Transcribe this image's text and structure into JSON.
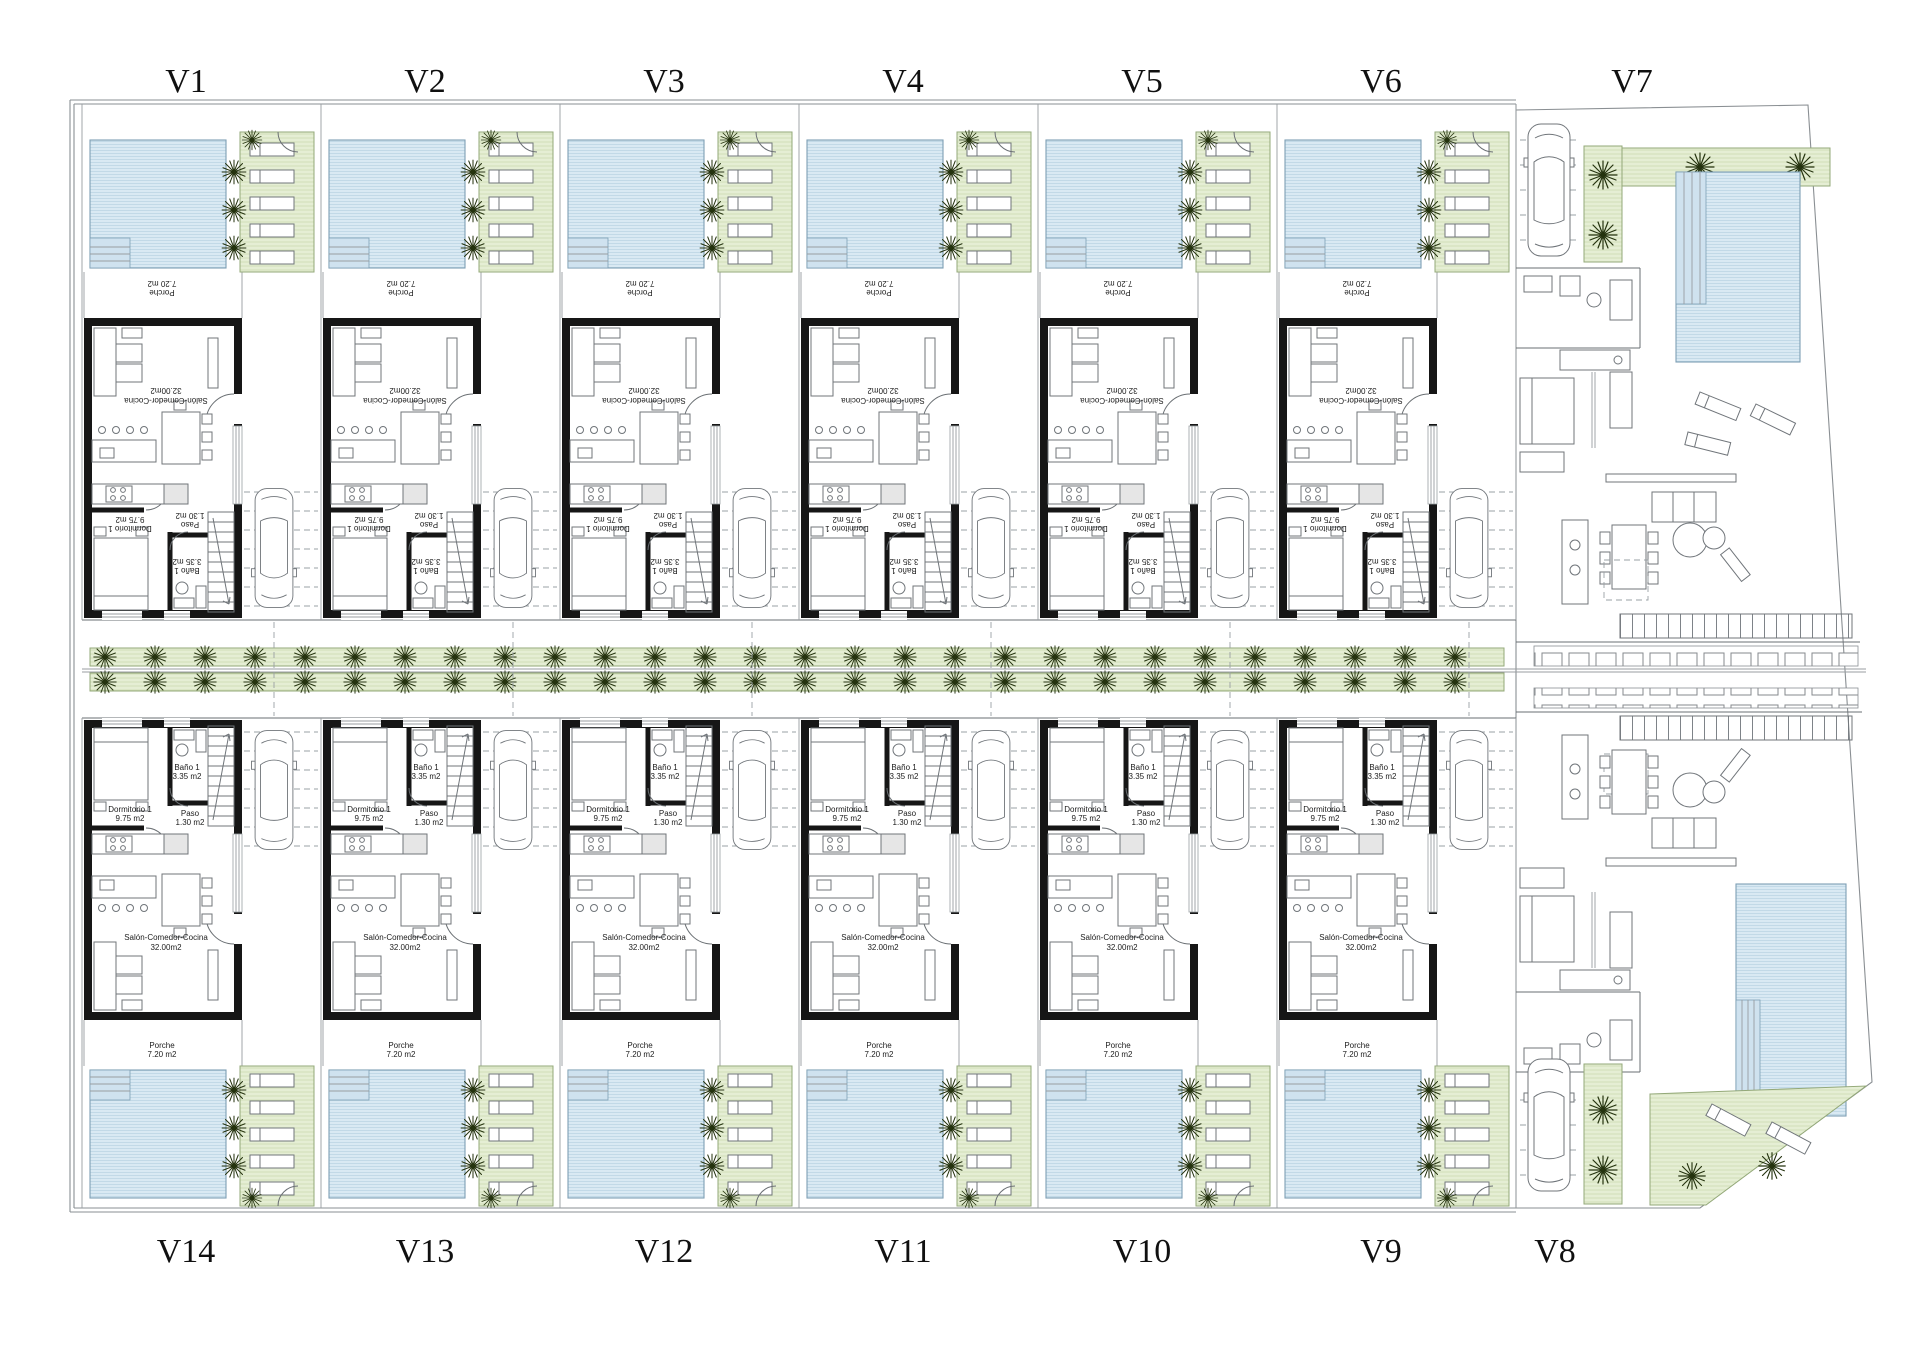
{
  "villas": {
    "top_row": [
      "V1",
      "V2",
      "V3",
      "V4",
      "V5",
      "V6",
      "V7"
    ],
    "bottom_row": [
      "V14",
      "V13",
      "V12",
      "V11",
      "V10",
      "V9",
      "V8"
    ]
  },
  "rooms": {
    "dormitorio": {
      "name": "Dormitorio 1",
      "area": "9.75 m2"
    },
    "bano": {
      "name": "Baño 1",
      "area": "3.35 m2"
    },
    "paso": {
      "name": "Paso",
      "area": "1.30 m2"
    },
    "salon": {
      "name": "Salón-Comedor-Cocina",
      "area": "32.00m2"
    },
    "porche": {
      "name": "Porche",
      "area": "7.20 m2"
    }
  },
  "colors": {
    "paper": "#ffffff",
    "pool_fill": "#d9e9f3",
    "pool_hatch": "#b9d3e3",
    "pool_border": "#7d9fb4",
    "green_fill": "#e5eed4",
    "green_hatch": "#c9d8ab",
    "green_border": "#93a878",
    "wall": "#161616",
    "line": "#6a6f73",
    "label": "#101010",
    "palm": "#25330f"
  },
  "icons": {
    "palm-icon": "radial frond asterisk",
    "car-icon": "car top view rounded rectangle",
    "sun-lounger-icon": "small white rectangle with pillow line",
    "stairs-icon": "treaded rectangle with direction arrow"
  }
}
